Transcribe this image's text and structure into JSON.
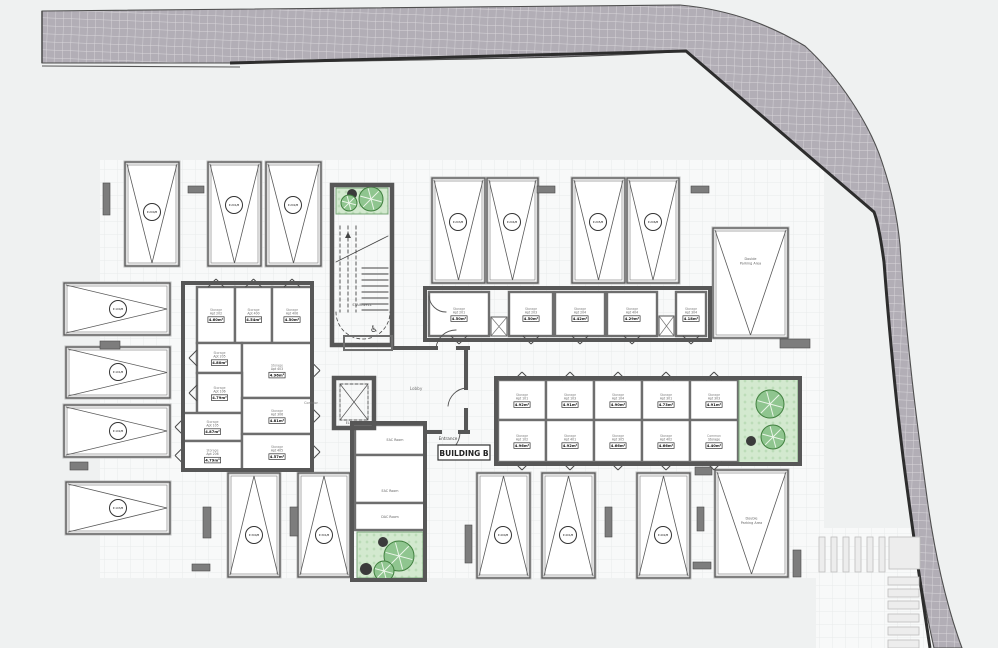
{
  "plan": {
    "building_label": "BUILDING B",
    "entrance_label": "Entrance",
    "room_labels": {
      "stairwell": "STAIRWELL",
      "electrical": "ELECTRICAL",
      "elevator": "ELEVATOR",
      "corridor": "Corridor",
      "lobby": "Lobby"
    },
    "service_rooms": [
      {
        "label": "EAC Room",
        "x": 355,
        "y": 425,
        "w": 70,
        "h": 30,
        "lx": 395,
        "ly": 441
      },
      {
        "label": "EAC Room",
        "x": 355,
        "y": 455,
        "w": 70,
        "h": 48,
        "lx": 390,
        "ly": 492
      },
      {
        "label": "DAC Room",
        "x": 355,
        "y": 503,
        "w": 70,
        "h": 27,
        "lx": 390,
        "ly": 518
      }
    ],
    "storage_rooms": [
      {
        "lines": [
          "Storage",
          "Apt 202"
        ],
        "area": "4.60m²",
        "x": 197,
        "y": 287,
        "w": 38,
        "h": 56,
        "door": "up"
      },
      {
        "lines": [
          "Storage",
          "Apt 400"
        ],
        "area": "4.54m²",
        "x": 235,
        "y": 287,
        "w": 37,
        "h": 56,
        "door": "up"
      },
      {
        "lines": [
          "Storage",
          "Apt 406"
        ],
        "area": "4.50m²",
        "x": 272,
        "y": 287,
        "w": 40,
        "h": 56,
        "door": "up"
      },
      {
        "lines": [
          "Storage",
          "Apt 205"
        ],
        "area": "4.80m²",
        "x": 197,
        "y": 343,
        "w": 45,
        "h": 30,
        "door": "left"
      },
      {
        "lines": [
          "Storage",
          "Apt 403"
        ],
        "area": "4.96m²",
        "x": 242,
        "y": 343,
        "w": 70,
        "h": 55,
        "door": "right"
      },
      {
        "lines": [
          "Storage",
          "Apt 106"
        ],
        "area": "4.79m²",
        "x": 197,
        "y": 373,
        "w": 45,
        "h": 40,
        "door": "left"
      },
      {
        "lines": [
          "Storage",
          "Apt 105"
        ],
        "area": "4.87m²",
        "x": 183,
        "y": 413,
        "w": 59,
        "h": 28,
        "door": "left"
      },
      {
        "lines": [
          "Storage",
          "Apt 306"
        ],
        "area": "4.81m²",
        "x": 242,
        "y": 398,
        "w": 70,
        "h": 36,
        "door": "right"
      },
      {
        "lines": [
          "Storage",
          "Apt 206"
        ],
        "area": "4.79m²",
        "x": 183,
        "y": 441,
        "w": 59,
        "h": 29,
        "door": "left"
      },
      {
        "lines": [
          "Storage",
          "Apt 405"
        ],
        "area": "4.57m²",
        "x": 242,
        "y": 434,
        "w": 70,
        "h": 36,
        "door": "right"
      },
      {
        "lines": [
          "Storage",
          "Apt 201"
        ],
        "area": "4.50m²",
        "x": 429,
        "y": 292,
        "w": 60,
        "h": 44,
        "door": "down"
      },
      {
        "lines": [
          "Storage",
          "Apt 203"
        ],
        "area": "4.50m²",
        "x": 509,
        "y": 292,
        "w": 44,
        "h": 44,
        "door": "down"
      },
      {
        "lines": [
          "Storage",
          "Apt 204"
        ],
        "area": "4.42m²",
        "x": 555,
        "y": 292,
        "w": 50,
        "h": 44,
        "door": "down"
      },
      {
        "lines": [
          "Storage",
          "Apt 404"
        ],
        "area": "4.29m²",
        "x": 607,
        "y": 292,
        "w": 50,
        "h": 44,
        "door": "down"
      },
      {
        "lines": [
          "Storage",
          "Apt 304"
        ],
        "area": "4.18m²",
        "x": 676,
        "y": 292,
        "w": 30,
        "h": 44,
        "door": "down"
      },
      {
        "lines": [
          "Storage",
          "Apt 101"
        ],
        "area": "4.92m²",
        "x": 498,
        "y": 380,
        "w": 48,
        "h": 40,
        "door": "up"
      },
      {
        "lines": [
          "Storage",
          "Apt 103"
        ],
        "area": "4.91m²",
        "x": 546,
        "y": 380,
        "w": 48,
        "h": 40,
        "door": "up"
      },
      {
        "lines": [
          "Storage",
          "Apt 104"
        ],
        "area": "4.90m²",
        "x": 594,
        "y": 380,
        "w": 48,
        "h": 40,
        "door": "up"
      },
      {
        "lines": [
          "Storage",
          "Apt 301"
        ],
        "area": "4.73m²",
        "x": 642,
        "y": 380,
        "w": 48,
        "h": 40,
        "door": "up"
      },
      {
        "lines": [
          "Storage",
          "Apt 303"
        ],
        "area": "4.91m²",
        "x": 690,
        "y": 380,
        "w": 48,
        "h": 40,
        "door": "up"
      },
      {
        "lines": [
          "Storage",
          "Apt 102"
        ],
        "area": "4.96m²",
        "x": 498,
        "y": 420,
        "w": 48,
        "h": 42,
        "door": "down"
      },
      {
        "lines": [
          "Storage",
          "Apt 401"
        ],
        "area": "4.92m²",
        "x": 546,
        "y": 420,
        "w": 48,
        "h": 42,
        "door": "down"
      },
      {
        "lines": [
          "Storage",
          "Apt 305"
        ],
        "area": "4.66m²",
        "x": 594,
        "y": 420,
        "w": 48,
        "h": 42,
        "door": "down"
      },
      {
        "lines": [
          "Storage",
          "Apt 402"
        ],
        "area": "4.66m²",
        "x": 642,
        "y": 420,
        "w": 48,
        "h": 42,
        "door": "down"
      },
      {
        "lines": [
          "Common",
          "Storage"
        ],
        "area": "4.40m²",
        "x": 690,
        "y": 420,
        "w": 48,
        "h": 42,
        "door": "down"
      }
    ],
    "parking_spaces": [
      {
        "code": "P-200/B",
        "x": 125,
        "y": 162,
        "w": 54,
        "h": 104,
        "apex": "down",
        "cx": 152,
        "cy": 212
      },
      {
        "code": "P-201/B",
        "x": 208,
        "y": 162,
        "w": 53,
        "h": 104,
        "apex": "down",
        "cx": 234,
        "cy": 205
      },
      {
        "code": "P-202/B",
        "x": 266,
        "y": 162,
        "w": 55,
        "h": 104,
        "apex": "down",
        "cx": 293,
        "cy": 205
      },
      {
        "code": "P-203/B",
        "x": 432,
        "y": 178,
        "w": 53,
        "h": 105,
        "apex": "down",
        "cx": 458,
        "cy": 222
      },
      {
        "code": "P-204/B",
        "x": 487,
        "y": 178,
        "w": 51,
        "h": 105,
        "apex": "down",
        "cx": 512,
        "cy": 222
      },
      {
        "code": "P-205/B",
        "x": 572,
        "y": 178,
        "w": 53,
        "h": 105,
        "apex": "down",
        "cx": 598,
        "cy": 222
      },
      {
        "code": "P-206/B",
        "x": 627,
        "y": 178,
        "w": 52,
        "h": 105,
        "apex": "down",
        "cx": 653,
        "cy": 222
      },
      {
        "code": "P-100/B",
        "x": 64,
        "y": 283,
        "w": 106,
        "h": 52,
        "apex": "right",
        "cx": 118,
        "cy": 309
      },
      {
        "code": "P-101/B",
        "x": 66,
        "y": 347,
        "w": 104,
        "h": 51,
        "apex": "right",
        "cx": 118,
        "cy": 372
      },
      {
        "code": "P-102/B",
        "x": 64,
        "y": 405,
        "w": 106,
        "h": 52,
        "apex": "right",
        "cx": 118,
        "cy": 431
      },
      {
        "code": "P-103/B",
        "x": 66,
        "y": 482,
        "w": 104,
        "h": 52,
        "apex": "right",
        "cx": 118,
        "cy": 508
      },
      {
        "code": "P-300/B",
        "x": 228,
        "y": 473,
        "w": 52,
        "h": 104,
        "apex": "up",
        "cx": 254,
        "cy": 535
      },
      {
        "code": "P-301/B",
        "x": 298,
        "y": 473,
        "w": 52,
        "h": 104,
        "apex": "up",
        "cx": 324,
        "cy": 535
      },
      {
        "code": "P-400/B",
        "x": 477,
        "y": 473,
        "w": 53,
        "h": 105,
        "apex": "up",
        "cx": 503,
        "cy": 535
      },
      {
        "code": "P-401/B",
        "x": 542,
        "y": 473,
        "w": 53,
        "h": 105,
        "apex": "up",
        "cx": 568,
        "cy": 535
      },
      {
        "code": "P-402/B",
        "x": 637,
        "y": 473,
        "w": 53,
        "h": 105,
        "apex": "up",
        "cx": 663,
        "cy": 535
      }
    ],
    "double_parking": [
      {
        "lines": [
          "Double",
          "Parking Area"
        ],
        "x": 713,
        "y": 228,
        "w": 75,
        "h": 110,
        "apex": "down",
        "ldy": -21
      },
      {
        "lines": [
          "Double",
          "Parking Area"
        ],
        "x": 715,
        "y": 470,
        "w": 73,
        "h": 107,
        "apex": "down",
        "ldy": -2
      }
    ],
    "pillars": [
      [
        103,
        183,
        7,
        32
      ],
      [
        188,
        186,
        16,
        7
      ],
      [
        537,
        186,
        18,
        7
      ],
      [
        691,
        186,
        18,
        7
      ],
      [
        100,
        341,
        20,
        8
      ],
      [
        70,
        462,
        18,
        8
      ],
      [
        203,
        507,
        8,
        31
      ],
      [
        290,
        507,
        8,
        29
      ],
      [
        192,
        564,
        18,
        7
      ],
      [
        465,
        525,
        7,
        38
      ],
      [
        605,
        507,
        7,
        30
      ],
      [
        697,
        507,
        7,
        24
      ],
      [
        693,
        562,
        18,
        7
      ],
      [
        695,
        467,
        17,
        8
      ],
      [
        793,
        550,
        8,
        27
      ],
      [
        780,
        339,
        30,
        9
      ]
    ],
    "green_areas": [
      {
        "x": 336,
        "y": 188,
        "w": 52,
        "h": 26,
        "trees": [
          {
            "t": "dark",
            "cx": 352,
            "cy": 194,
            "r": 5
          },
          {
            "t": "leafy",
            "cx": 371,
            "cy": 199,
            "r": 12
          },
          {
            "t": "leafy",
            "cx": 349,
            "cy": 203,
            "r": 8
          }
        ]
      },
      {
        "x": 357,
        "y": 532,
        "w": 66,
        "h": 46,
        "trees": [
          {
            "t": "dark",
            "cx": 383,
            "cy": 542,
            "r": 5
          },
          {
            "t": "dark",
            "cx": 366,
            "cy": 569,
            "r": 6
          },
          {
            "t": "leafy",
            "cx": 399,
            "cy": 556,
            "r": 15
          },
          {
            "t": "leafy",
            "cx": 384,
            "cy": 571,
            "r": 10
          }
        ]
      },
      {
        "x": 739,
        "y": 378,
        "w": 59,
        "h": 86,
        "trees": [
          {
            "t": "leafy",
            "cx": 770,
            "cy": 404,
            "r": 14
          },
          {
            "t": "leafy",
            "cx": 773,
            "cy": 437,
            "r": 12
          },
          {
            "t": "dark",
            "cx": 751,
            "cy": 441,
            "r": 5
          }
        ]
      }
    ],
    "shafts": [
      [
        491,
        317,
        16,
        19
      ],
      [
        659,
        316,
        15,
        20
      ]
    ],
    "crosswalk": {
      "v_bars_x": [
        819,
        831,
        843,
        855,
        867,
        879
      ],
      "v_bar_y": 537,
      "v_bar_w": 6,
      "v_bar_h": 35,
      "square": [
        889,
        537,
        31,
        32
      ],
      "h_bars_y": [
        577,
        589,
        601,
        614,
        627,
        640
      ],
      "h_bar_x": 888,
      "h_bar_w": 31,
      "h_bar_h": 8
    },
    "colors": {
      "page": "#eff1f1",
      "parcel": "#f8f9f9",
      "parcel_grid": "#e9ebeb",
      "road": "#b2aeb6",
      "road_grid": "#cfccd3",
      "road_edge": "#4f4f4f",
      "curb": "#2d2d2d",
      "wall": "#575757",
      "partition": "#6e6e6e",
      "pillar": "#7d7d7d",
      "green": "#d3e9cf",
      "tree": "#8fc58f",
      "tree_edge": "#41803f",
      "dark_tree": "#3b3b3b",
      "stripe_fill": "#ededed",
      "stripe_edge": "#bcbcbc"
    }
  }
}
